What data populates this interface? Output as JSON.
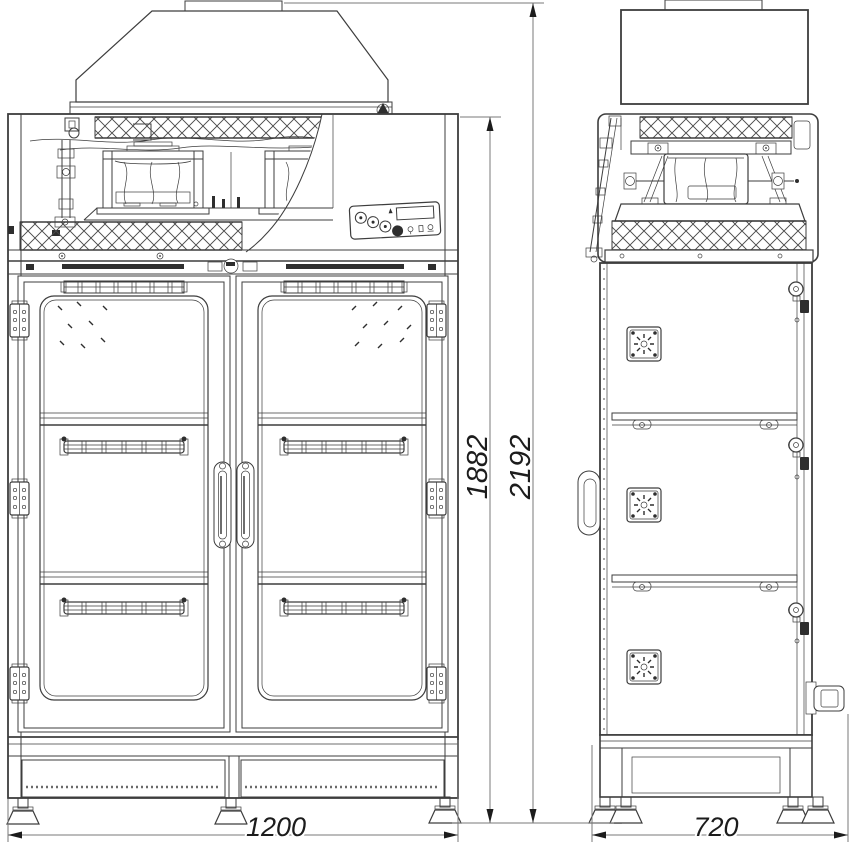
{
  "drawing": {
    "type": "two-view technical drawing of a double-door laboratory drying cabinet with exhaust hood",
    "views": {
      "left": "front elevation",
      "right": "side elevation"
    }
  },
  "dimensions": {
    "front_width": "1200",
    "side_depth": "720",
    "cabinet_height": "1882",
    "overall_height": "2192"
  },
  "colors": {
    "line": "#3d3d3d",
    "dimension_line": "#7a7a7a",
    "text": "#1c1c1c",
    "background": "#ffffff",
    "dark_fill": "#2e2e2e"
  }
}
